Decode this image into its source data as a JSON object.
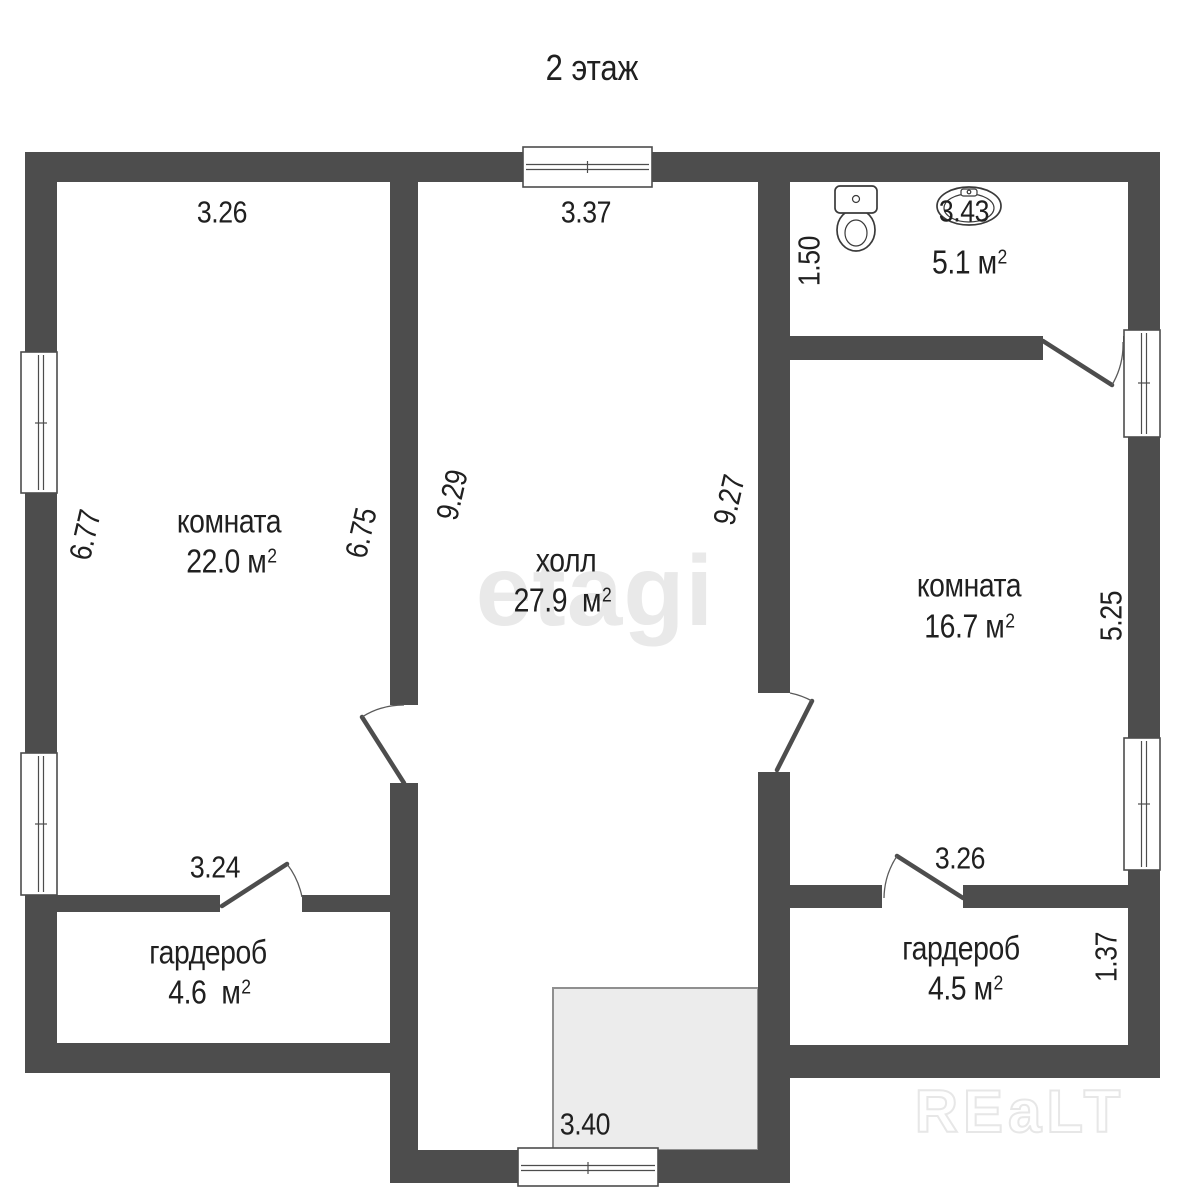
{
  "title": "2 этаж",
  "colors": {
    "wall": "#4d4d4d",
    "stairs": "#ececec",
    "fixture": "#3a3a3a",
    "text": "#202020",
    "watermark_center": "#e9e9e9",
    "watermark_corner": "#e7e7e7"
  },
  "rooms": {
    "left": {
      "name": "комната",
      "area": "22.0",
      "unit": "м",
      "sup": "2"
    },
    "hall": {
      "name": "холл",
      "area": "27.9",
      "unit": "м",
      "sup": "2"
    },
    "right": {
      "name": "комната",
      "area": "16.7",
      "unit": "м",
      "sup": "2"
    },
    "bathroom": {
      "area": "5.1",
      "unit": "м",
      "sup": "2"
    },
    "wardrobe_left": {
      "name": "гардероб",
      "area": "4.6",
      "unit": "м",
      "sup": "2"
    },
    "wardrobe_right": {
      "name": "гардероб",
      "area": "4.5",
      "unit": "м",
      "sup": "2"
    }
  },
  "dimensions": {
    "top_left": "3.26",
    "top_center": "3.37",
    "top_right": "3.43",
    "bath_depth": "1.50",
    "left_room_height": "6.77",
    "left_room_height_inner": "6.75",
    "hall_height_left": "9.29",
    "hall_height_right": "9.27",
    "right_room_height": "5.25",
    "wardrobe_left_width": "3.24",
    "wardrobe_right_width": "3.26",
    "wardrobe_right_depth": "1.37",
    "stair_width": "3.40"
  },
  "watermarks": {
    "center": "etagi",
    "corner": "REaLT"
  },
  "fixtures": {
    "toilet": "toilet-icon",
    "sink": "sink-icon"
  }
}
